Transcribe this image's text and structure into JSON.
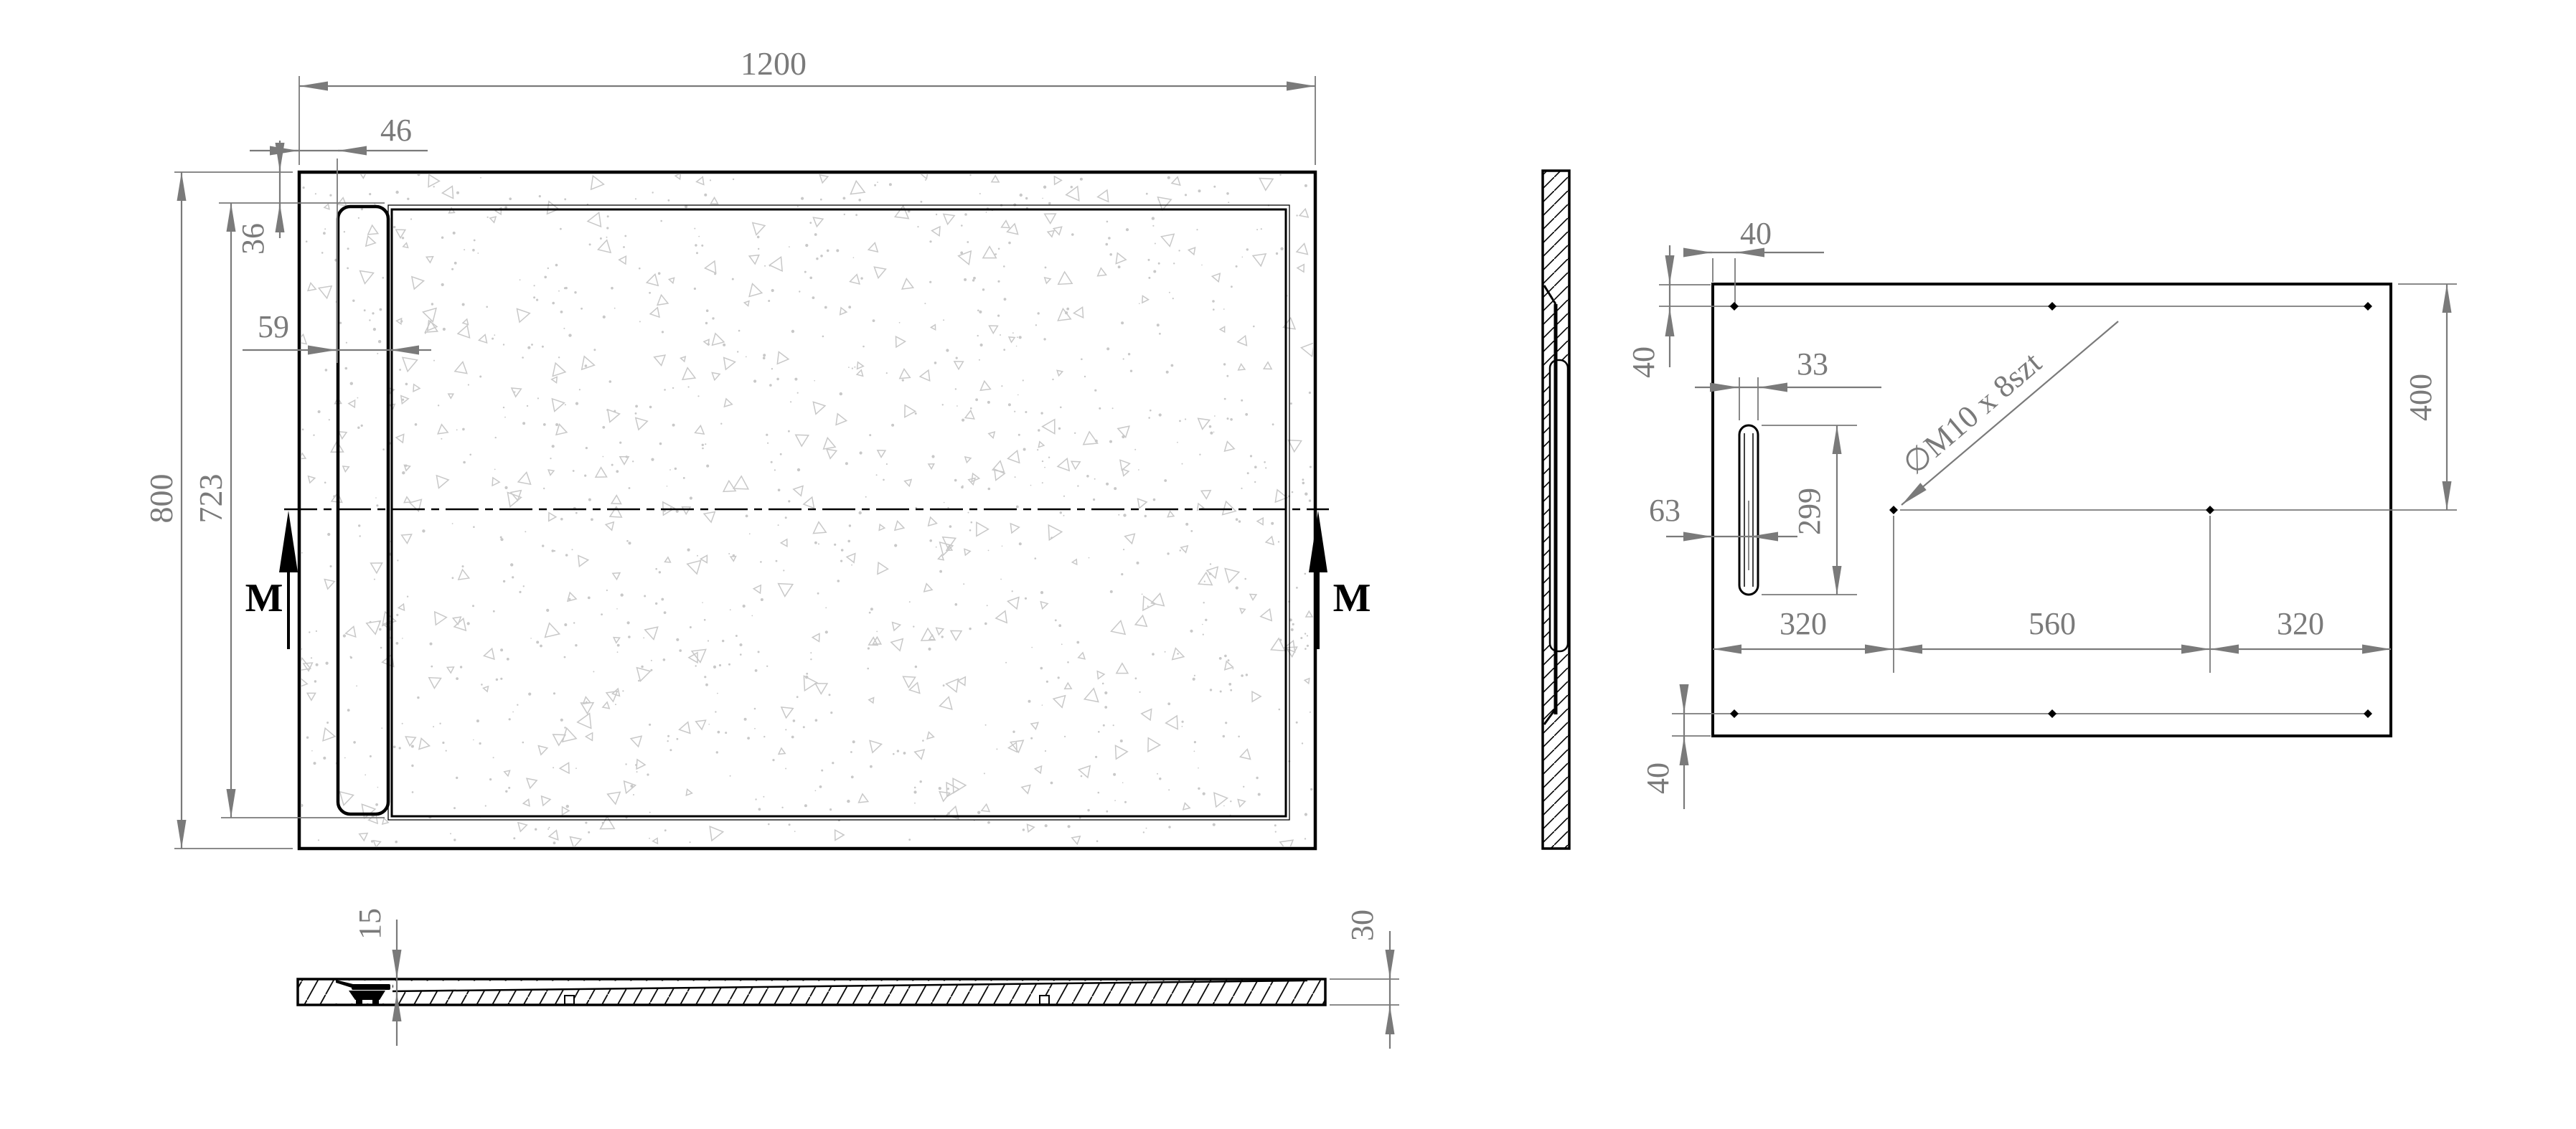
{
  "plan": {
    "overall_width": "1200",
    "overall_height": "800",
    "inner_height": "723",
    "edge_to_cover": "46",
    "rim_top": "36",
    "cover_width": "59",
    "section_marker": "M"
  },
  "back": {
    "hole_note": "∅M10 x 8szt",
    "corner_offset_h": "40",
    "top_row_offset": "40",
    "bottom_row_offset": "40",
    "slot_offset": "63",
    "slot_width": "33",
    "slot_height": "299",
    "col_span_left": "320",
    "col_span_mid": "560",
    "col_span_right": "320",
    "mid_row_offset": "400"
  },
  "section": {
    "basin_depth": "15",
    "edge_thickness": "30"
  },
  "colors": {
    "line": "#000000",
    "dim": "#7a7a7a",
    "speckle": "#c8c8c8"
  }
}
